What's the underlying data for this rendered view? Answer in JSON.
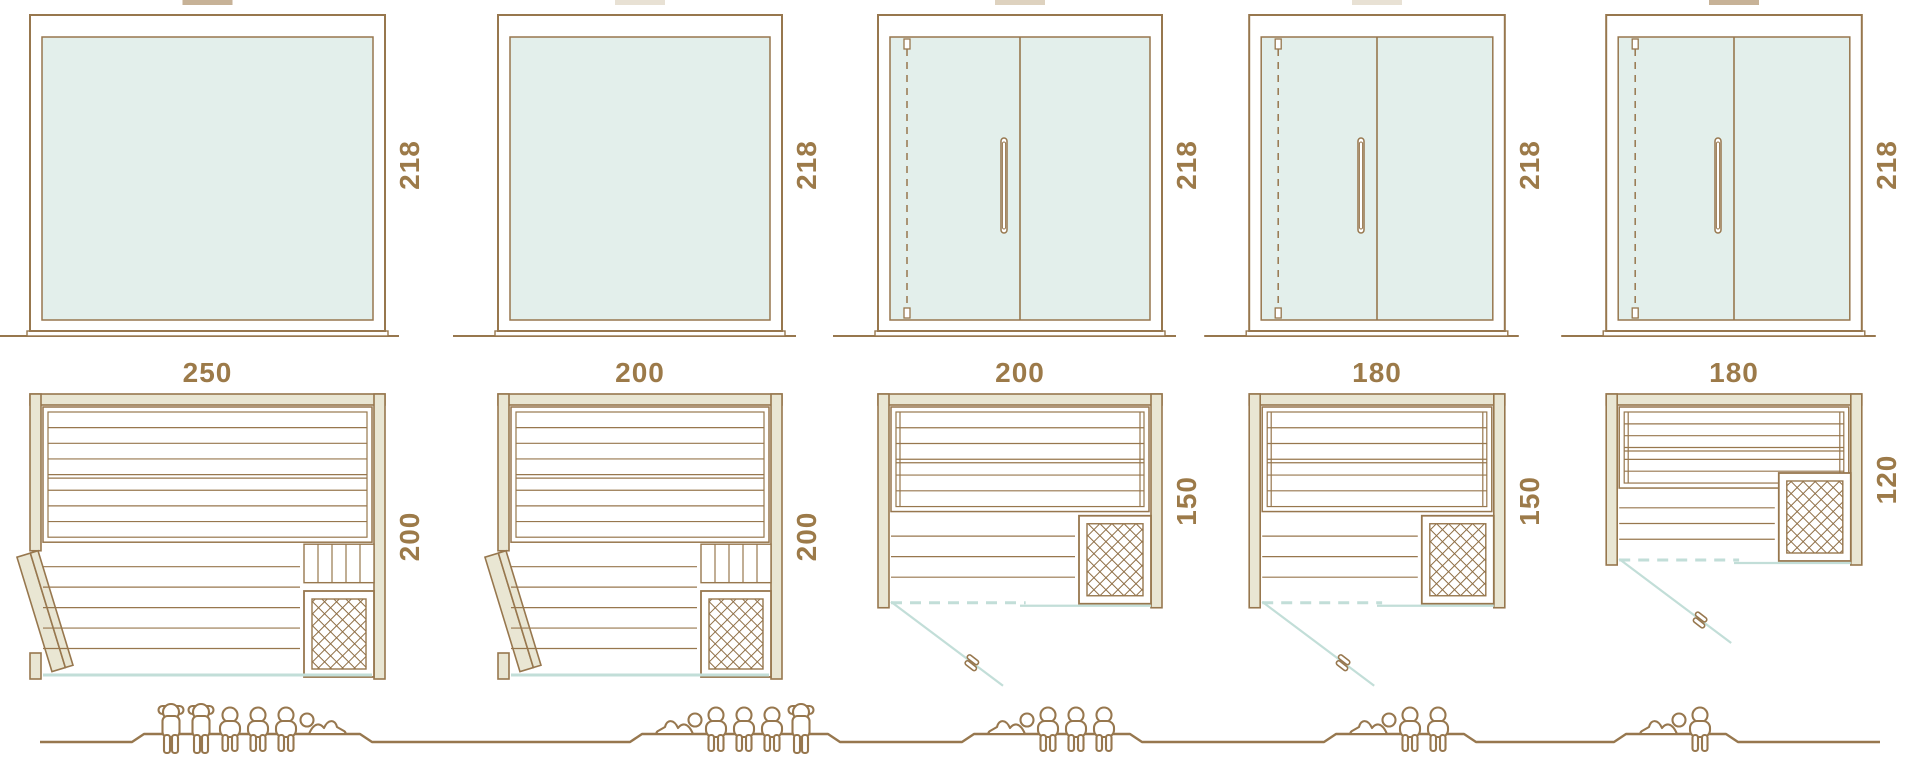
{
  "diagram_title": "sauna-cabin-size-comparison",
  "colors": {
    "stroke": "#97774e",
    "label_text": "#9c7a49",
    "glass_fill": "#e3efeb",
    "wall_fill": "#e9e6d3",
    "teal_line": "#c2ded8",
    "lattice": "#8f6f46",
    "white": "#ffffff"
  },
  "models": [
    {
      "front": {
        "width_label": "250",
        "height_label": "218",
        "width_cm": 250,
        "height_cm": 218,
        "has_glass_door": false
      },
      "plan": {
        "depth_label": "200",
        "depth_cm": 200,
        "door_style": "hinged-wood-side",
        "heater": "bottom-right"
      },
      "capacity": {
        "total": 6,
        "figures": [
          "standing",
          "standing",
          "sitting",
          "sitting",
          "sitting",
          "lying"
        ]
      },
      "top_fragment_color": "#c7b297"
    },
    {
      "front": {
        "width_label": "200",
        "height_label": "218",
        "width_cm": 200,
        "height_cm": 218,
        "has_glass_door": false
      },
      "plan": {
        "depth_label": "200",
        "depth_cm": 200,
        "door_style": "hinged-wood-side",
        "heater": "bottom-right"
      },
      "capacity": {
        "total": 5,
        "figures": [
          "lying",
          "sitting",
          "sitting",
          "sitting",
          "standing"
        ]
      },
      "top_fragment_color": "#e8e1d4"
    },
    {
      "front": {
        "width_label": "200",
        "height_label": "218",
        "width_cm": 200,
        "height_cm": 218,
        "has_glass_door": true
      },
      "plan": {
        "depth_label": "150",
        "depth_cm": 150,
        "door_style": "glass-front-swing",
        "heater": "bottom-right"
      },
      "capacity": {
        "total": 4,
        "figures": [
          "lying",
          "sitting",
          "sitting",
          "sitting"
        ]
      },
      "top_fragment_color": "#ded2bf"
    },
    {
      "front": {
        "width_label": "180",
        "height_label": "218",
        "width_cm": 180,
        "height_cm": 218,
        "has_glass_door": true
      },
      "plan": {
        "depth_label": "150",
        "depth_cm": 150,
        "door_style": "glass-front-swing",
        "heater": "bottom-right"
      },
      "capacity": {
        "total": 3,
        "figures": [
          "lying",
          "sitting",
          "sitting"
        ]
      },
      "top_fragment_color": "#e8e1d4"
    },
    {
      "front": {
        "width_label": "180",
        "height_label": "218",
        "width_cm": 180,
        "height_cm": 218,
        "has_glass_door": true
      },
      "plan": {
        "depth_label": "120",
        "depth_cm": 120,
        "door_style": "glass-front-swing",
        "heater": "bottom-right"
      },
      "capacity": {
        "total": 2,
        "figures": [
          "lying",
          "sitting"
        ]
      },
      "top_fragment_color": "#c7b297"
    }
  ]
}
